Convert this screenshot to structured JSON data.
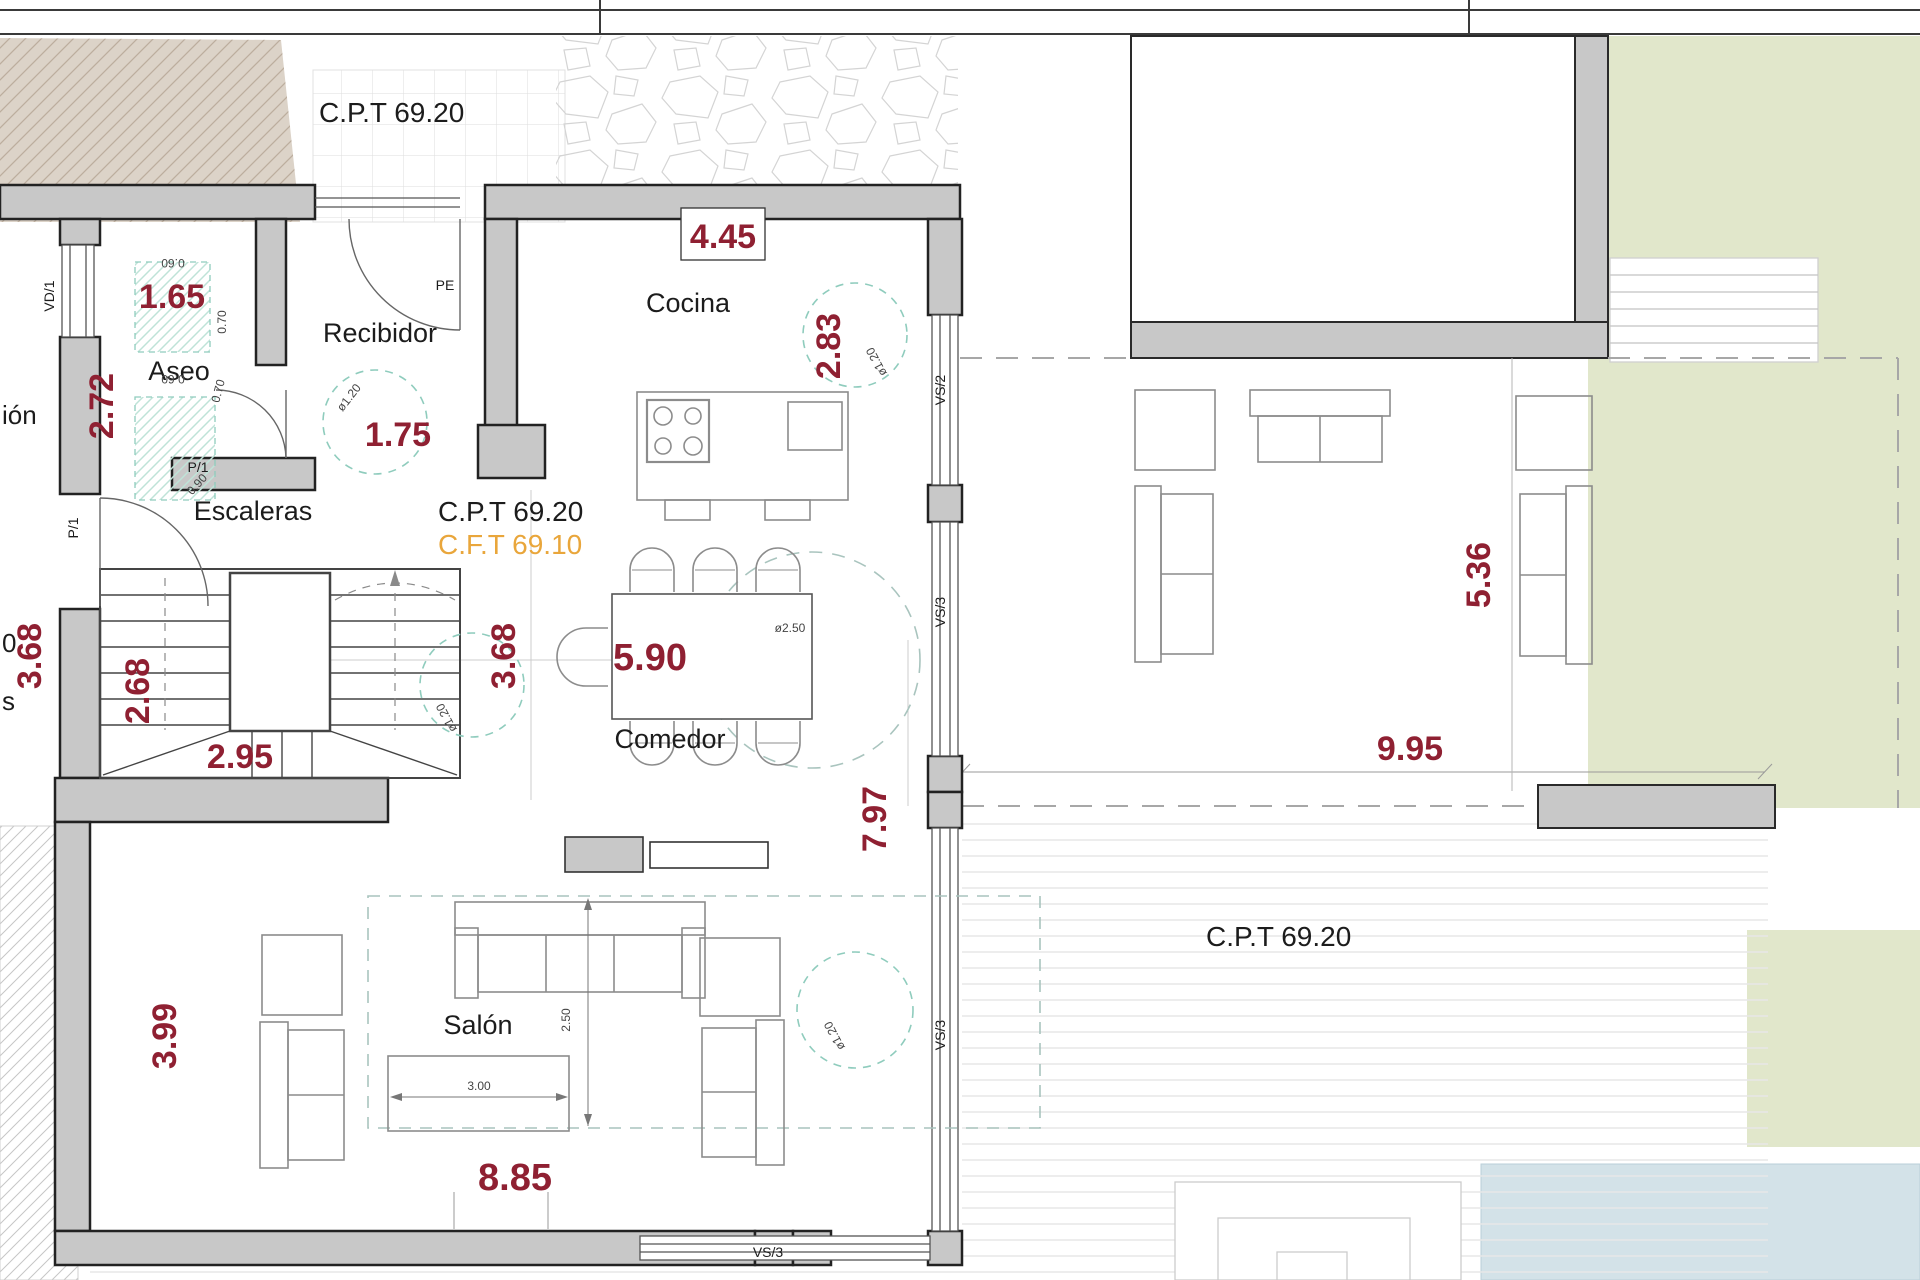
{
  "plan": {
    "levels": {
      "cpt_top": "C.P.T 69.20",
      "cpt_center": "C.P.T 69.20",
      "cft_center": "C.F.T 69.10",
      "cpt_terrace": "C.P.T 69.20"
    },
    "rooms": {
      "aseo": "Aseo",
      "recibidor": "Recibidor",
      "cocina": "Cocina",
      "escaleras": "Escaleras",
      "comedor": "Comedor",
      "salon": "Salón"
    },
    "edge_fragments": {
      "ion": "ión",
      "zero": "0",
      "s": "s"
    },
    "dims": {
      "d165": "1.65",
      "d272": "2.72",
      "d175": "1.75",
      "d445": "4.45",
      "d283": "2.83",
      "d368": "3.68",
      "d268": "2.68",
      "d295": "2.95",
      "d590": "5.90",
      "d797": "7.97",
      "d995": "9.95",
      "d536": "5.36",
      "d399": "3.99",
      "d885": "8.85"
    },
    "furniture_dims": {
      "d250v": "2.50",
      "d300": "3.00",
      "dia250": "ø2.50",
      "dia120": "ø1.20",
      "d060": "0.60",
      "d070": "0.70",
      "d090": "0.90"
    },
    "openings": {
      "vd1": "VD/1",
      "pe": "PE",
      "p1": "P/1",
      "vs2": "VS/2",
      "vs3": "VS/3"
    },
    "colors": {
      "wall": "#c8c8c8",
      "dim_red": "#8f2032",
      "cft_orange": "#e9a63b",
      "teal": "#8fccbd",
      "lawn_green": "#e1e7cb",
      "pool_blue": "#d3e2e8",
      "beige": "#dcd3c8"
    }
  }
}
